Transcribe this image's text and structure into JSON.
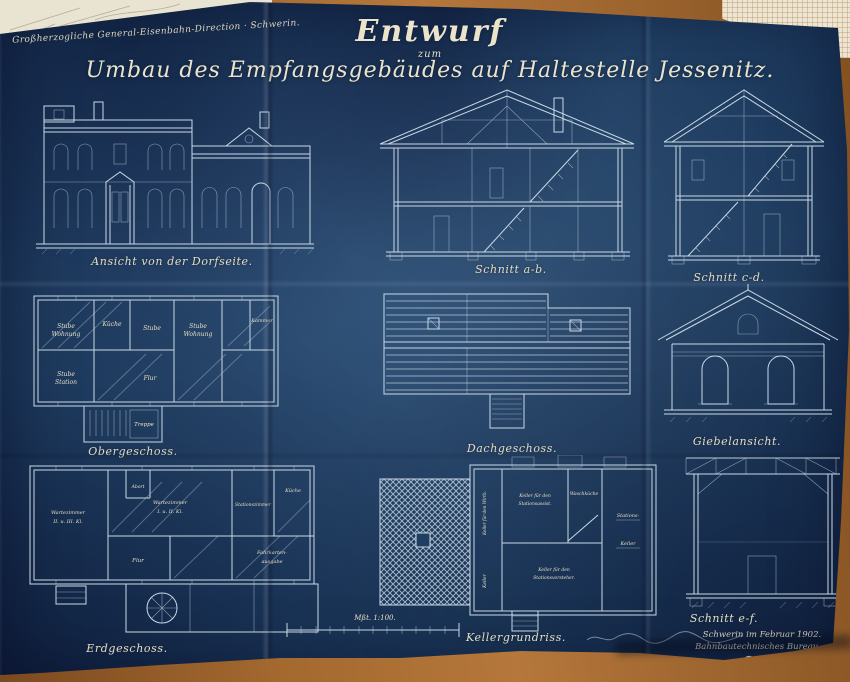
{
  "colors": {
    "blueprint_blue": "#1f3e62",
    "line_white": "#c9d9e6",
    "ink_cream": "#e7dfc5",
    "wood_brown": "#a4692f",
    "paper_cream": "#ece6d2"
  },
  "stamp": {
    "office_note": "Großherzogliche General-Eisenbahn-Direction · Schwerin."
  },
  "title": {
    "line1": "Entwurf",
    "line2": "zum",
    "line3": "Umbau des Empfangsgebäudes auf Haltestelle Jessenitz."
  },
  "drawings": [
    {
      "caption": "Ansicht von der Dorfseite."
    },
    {
      "caption": "Schnitt a-b."
    },
    {
      "caption": "Schnitt c-d."
    },
    {
      "caption": "Obergeschoss.",
      "rooms": [
        [
          "Stube",
          "Wohnung"
        ],
        [
          "Küche"
        ],
        [
          "Stube"
        ],
        [
          "Stube",
          "Wohnung"
        ],
        [
          "Kammer"
        ],
        [
          "Stube",
          "Station"
        ],
        [
          "Flur"
        ],
        [
          "Treppe"
        ]
      ]
    },
    {
      "caption": "Dachgeschoss."
    },
    {
      "caption": "Giebelansicht."
    },
    {
      "caption": "Erdgeschoss.",
      "rooms": [
        [
          "Wartezimmer",
          "II. u. III. Kl."
        ],
        [
          "Abort"
        ],
        [
          "Wartezimmer",
          "I. u. II. Kl."
        ],
        [
          "Stationszimmer"
        ],
        [
          "Flur"
        ],
        [
          "Fahrkarten-",
          "ausgabe"
        ],
        [
          "Küche"
        ]
      ]
    },
    {
      "caption": "Kellergrundriss.",
      "rooms": [
        [
          "Keller für den Wirth."
        ],
        [
          "Keller für den",
          "Stationsassist."
        ],
        [
          "Waschküche"
        ],
        [
          "Stations-",
          "Keller"
        ],
        [
          "Keller für den",
          "Stationsvorsteher."
        ],
        [
          "Keller"
        ]
      ]
    },
    {
      "caption": "Schnitt e-f."
    }
  ],
  "scale_bar": {
    "label": "Mßt. 1:100."
  },
  "footer": {
    "place_date": "Schwerin im Februar 1902.",
    "office": "Bahnbautechnisches Bureau."
  }
}
